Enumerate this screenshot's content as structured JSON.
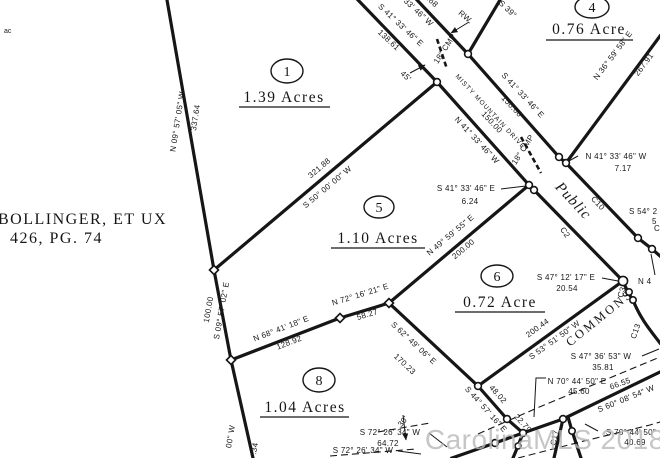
{
  "colors": {
    "line": "#161616",
    "background": "#ffffff",
    "watermark_gray": "#b9b9b9"
  },
  "owner": {
    "line1": "BOLLINGER, ET UX",
    "line2": "426, PG. 74"
  },
  "corner_text": "ac",
  "watermark": "CarolinaMLS 2018,",
  "parcels": [
    {
      "number": "1",
      "acreage": "1.39 Acres"
    },
    {
      "number": "4",
      "acreage": "0.76 Acre"
    },
    {
      "number": "5",
      "acreage": "1.10 Acres"
    },
    {
      "number": "6",
      "acreage": "0.72 Acre"
    },
    {
      "number": "8",
      "acreage": "1.04 Acres"
    }
  ],
  "roads": {
    "misty_mountain_drive": "MISTY MOUNTAIN DRIVE",
    "public": "Public",
    "commons": "COMMONS"
  },
  "curves": {
    "c2": "C2",
    "c3": "C3",
    "c10": "C10",
    "c13": "C13",
    "c17": "C17"
  },
  "annotations": {
    "rw": "RW.",
    "road_width": "45'",
    "culvert_upper": "18\" CMP",
    "culvert_lower": "18\" CMP",
    "setback": "30'"
  },
  "bearings": [
    {
      "bearing": "N 09° 57' 05\" W",
      "distance": "337.64"
    },
    {
      "bearing": "S 09° 57' 02\" E",
      "distance": "100.00"
    },
    {
      "bearing": "S 50° 00' 00\" W",
      "distance": "321.88"
    },
    {
      "bearing": "S 41° 33' 46\" E",
      "distance": "138.61"
    },
    {
      "bearing": "S 41° 33' 46\" E",
      "distance": "150.00"
    },
    {
      "bearing": "N 41° 33' 46\" W",
      "distance": "150.00"
    },
    {
      "bearing": "N 36° 59' 58\" E",
      "distance": "267.91"
    },
    {
      "bearing": "N 41° 33' 46\" W",
      "distance": "7.17"
    },
    {
      "bearing": "S 41° 33' 46\" E",
      "distance": "6.24"
    },
    {
      "bearing": "N 49° 59' 55\" E",
      "distance": "200.00"
    },
    {
      "bearing": "N 72° 16' 21\" E",
      "distance": "58.27"
    },
    {
      "bearing": "N 68° 41' 18\" E",
      "distance": "128.92"
    },
    {
      "bearing": "S 62° 49' 06\" E",
      "distance": "170.23"
    },
    {
      "bearing": "S 53° 51' 50\" W",
      "distance": "200.44"
    },
    {
      "bearing": "S 47° 12' 17\" E",
      "distance": "20.54"
    },
    {
      "bearing": "S 47° 36' 53\" W",
      "distance": "35.81"
    },
    {
      "bearing": "N 70° 44' 50\" E",
      "distance": "45.60"
    },
    {
      "bearing": "S 60° 08' 54\" W",
      "distance": "66.55"
    },
    {
      "bearing": "S 70° 44' 50\"",
      "distance": "40.69"
    },
    {
      "bearing": "S 44° 57' 16\" E",
      "distance": "48.02"
    },
    {
      "bearing": "",
      "distance": "22.79"
    },
    {
      "bearing": "S 72° 26' 34\" W",
      "distance": "64.72"
    },
    {
      "bearing": "S 72° 26' 34\" W",
      "distance": ""
    }
  ],
  "fragments": {
    "n41_top": "N 41° 33' 46\" W",
    "d5_68": "5.68",
    "s39": "S 39°",
    "w00": "00\" W",
    "d34": ".34",
    "s54_line1": "S 54° 2",
    "s54_line2": "5",
    "n4": "N 4",
    "c": "C"
  }
}
